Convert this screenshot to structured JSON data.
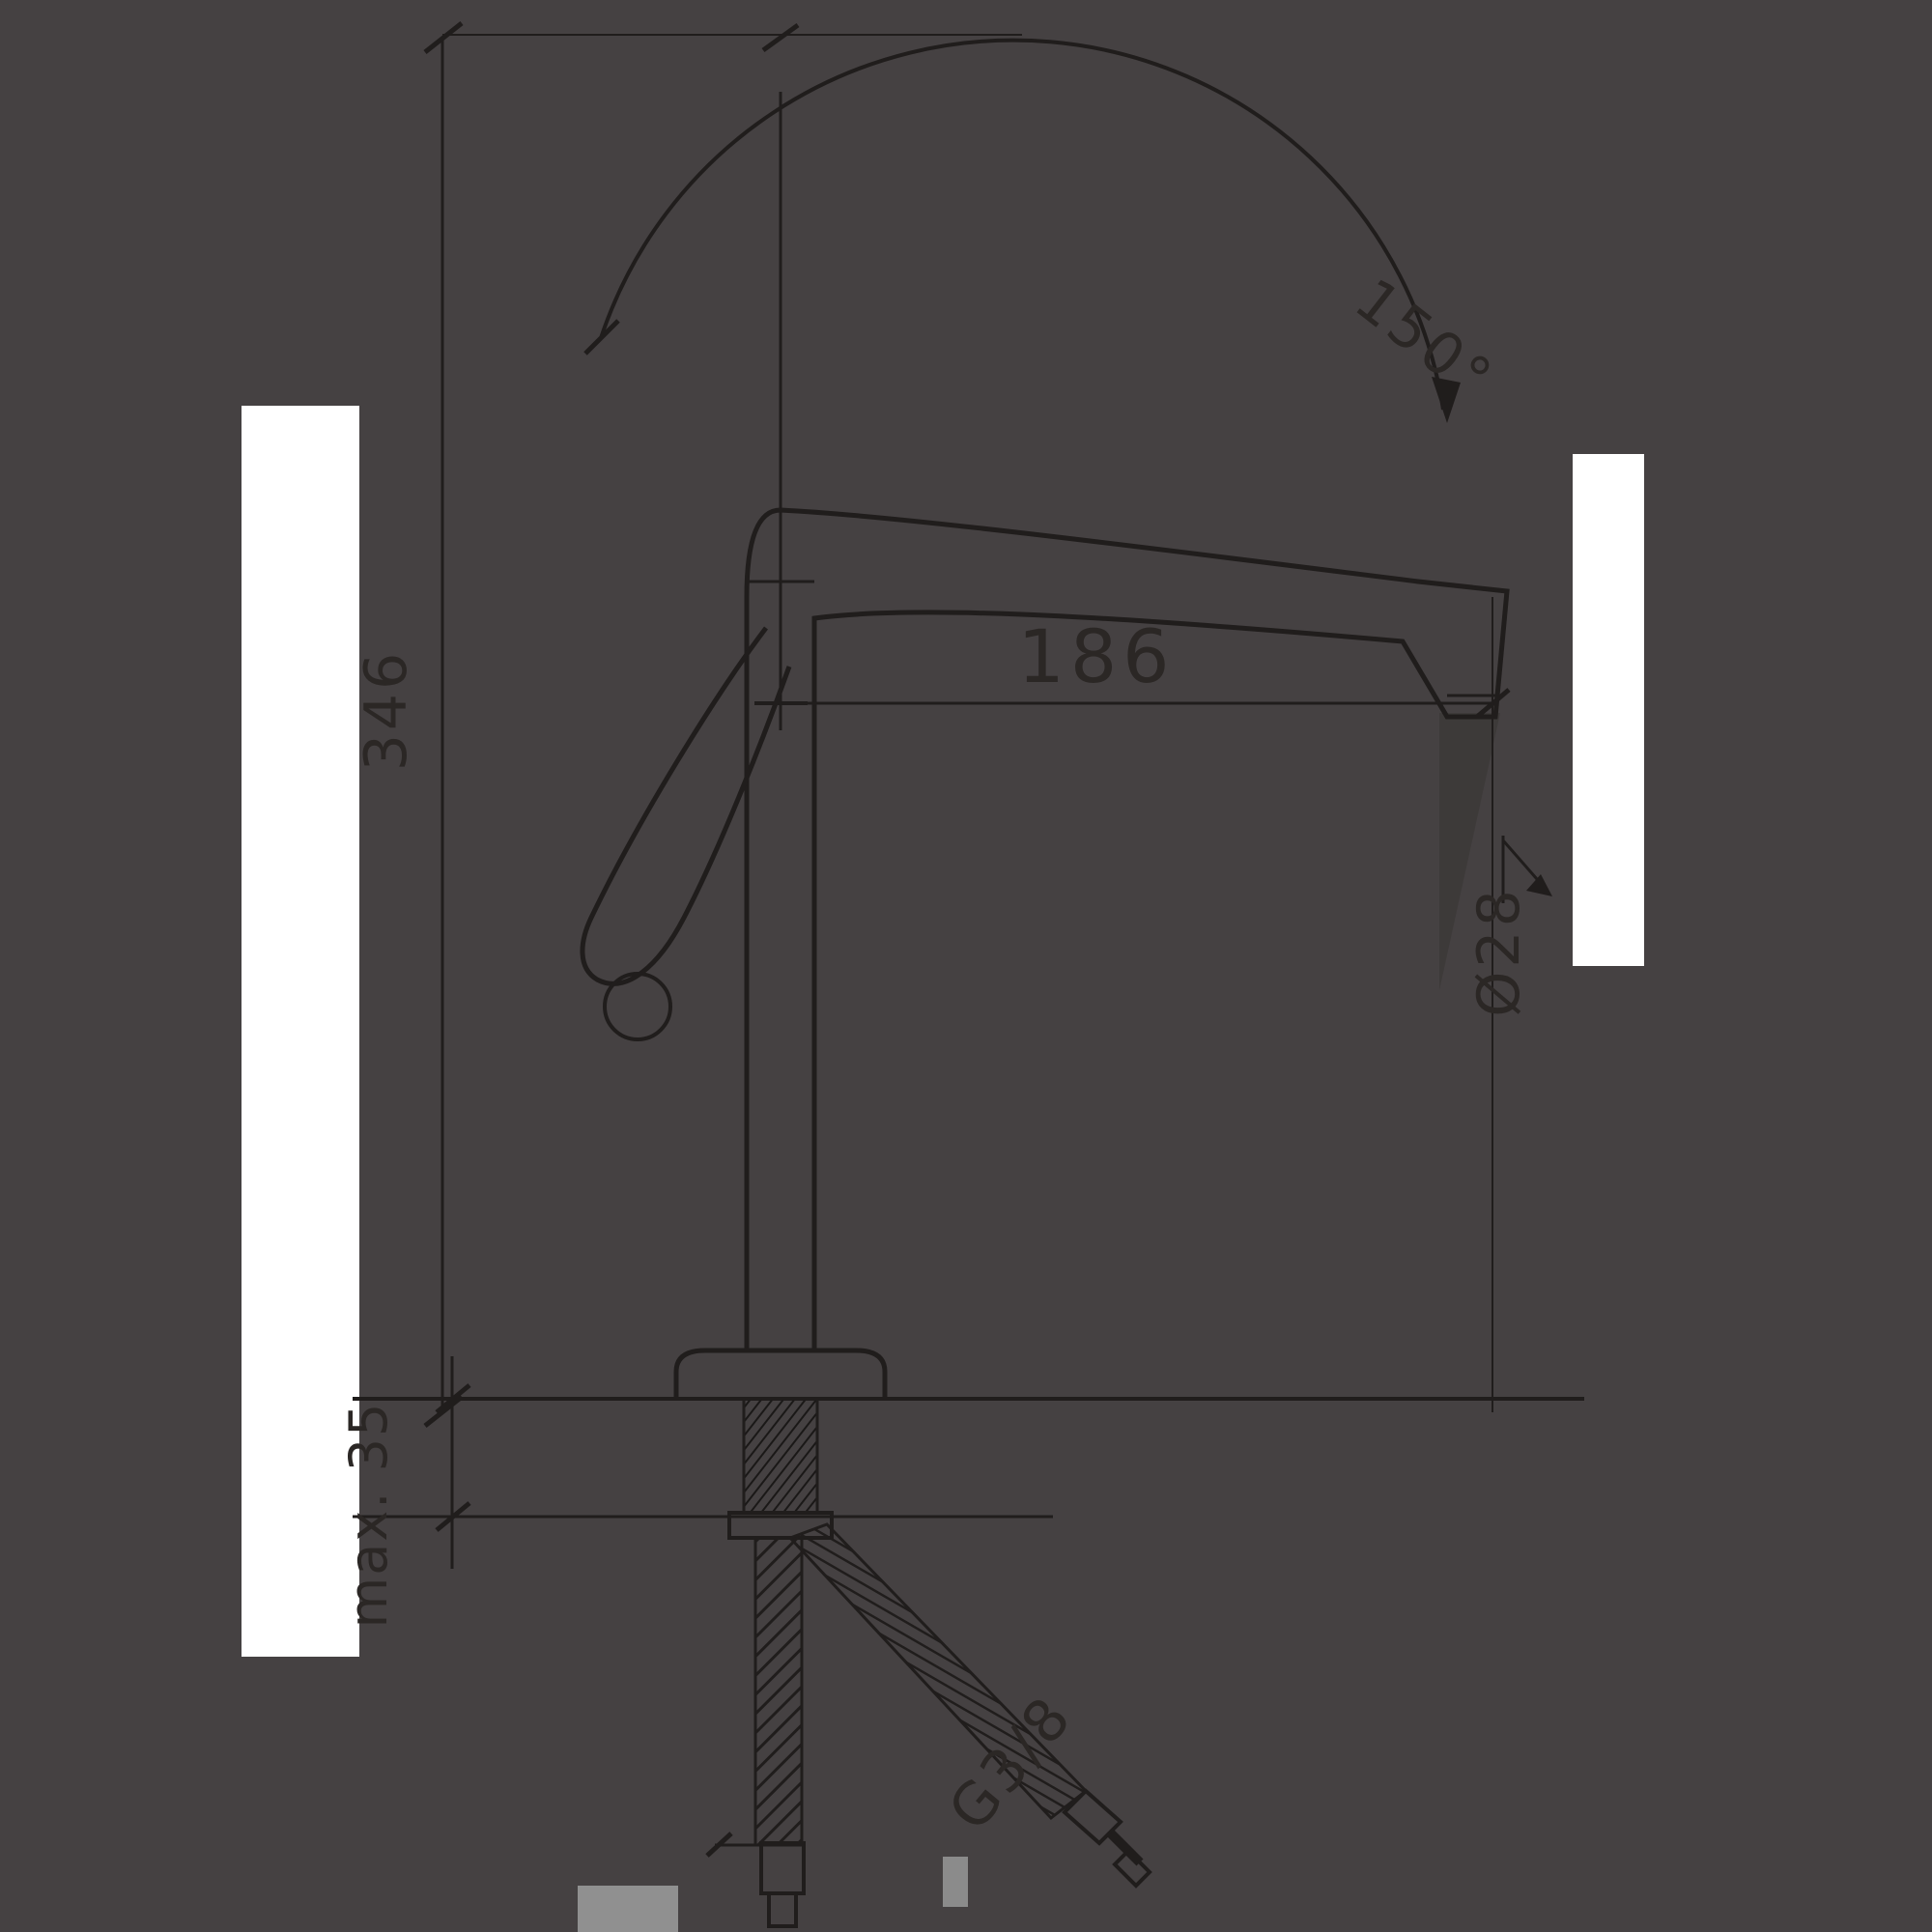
{
  "title": "Kitchen mixer tap — technical dimension drawing",
  "colors": {
    "background": "#454142",
    "ink": "#201d1c",
    "text": "#2b2725",
    "artifact_white": "#ffffff",
    "artifact_gray": "#909090",
    "shadow": "#3d3a39"
  },
  "drawing": {
    "type": "technical-dimension-drawing",
    "subject": "single-lever kitchen faucet, side elevation with supply hoses",
    "dimensions": {
      "spout_reach": "186",
      "total_height": "346",
      "swivel_angle": "150°",
      "outlet_diameter": "Ø28",
      "deck_thickness": "max. 35",
      "connection_thread": "G3/8"
    }
  }
}
